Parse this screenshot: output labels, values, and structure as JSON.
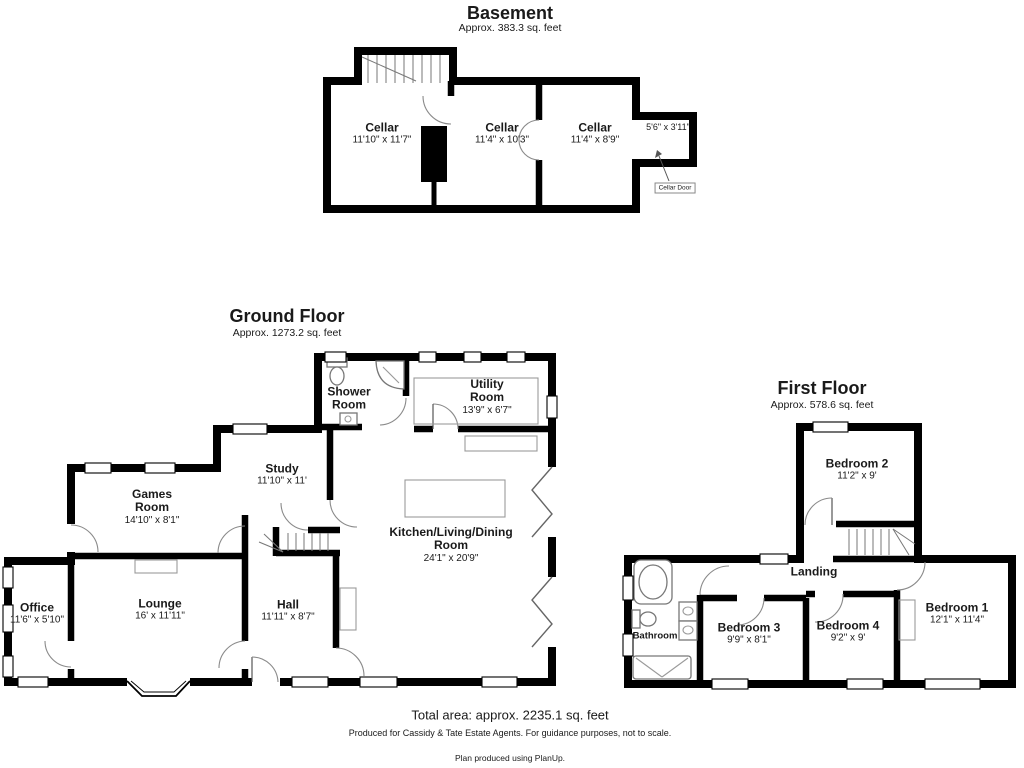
{
  "floors": {
    "basement": {
      "title": "Basement",
      "area": "Approx. 383.3 sq. feet",
      "rooms": [
        {
          "name": "Cellar",
          "dims": "11'10\" x 11'7\""
        },
        {
          "name": "Cellar",
          "dims": "11'4\" x 10'3\""
        },
        {
          "name": "Cellar",
          "dims": "11'4\" x 8'9\""
        }
      ],
      "annex_dims": "5'6\" x 3'11\"",
      "door_label": "Cellar Door"
    },
    "ground": {
      "title": "Ground Floor",
      "area": "Approx. 1273.2 sq. feet",
      "rooms": [
        {
          "name": "Shower Room",
          "dims": ""
        },
        {
          "name": "Utility Room",
          "dims": "13'9\" x 6'7\""
        },
        {
          "name": "Study",
          "dims": "11'10\" x 11'"
        },
        {
          "name": "Games Room",
          "dims": "14'10\" x 8'1\""
        },
        {
          "name": "Kitchen/Living/Dining Room",
          "dims": "24'1\" x 20'9\""
        },
        {
          "name": "Office",
          "dims": "11'6\" x 5'10\""
        },
        {
          "name": "Lounge",
          "dims": "16' x 11'11\""
        },
        {
          "name": "Hall",
          "dims": "11'11\" x 8'7\""
        }
      ]
    },
    "first": {
      "title": "First Floor",
      "area": "Approx. 578.6 sq. feet",
      "rooms": [
        {
          "name": "Bedroom 2",
          "dims": "11'2\" x 9'"
        },
        {
          "name": "Landing",
          "dims": ""
        },
        {
          "name": "Bathroom",
          "dims": ""
        },
        {
          "name": "Bedroom 3",
          "dims": "9'9\" x 8'1\""
        },
        {
          "name": "Bedroom 4",
          "dims": "9'2\" x 9'"
        },
        {
          "name": "Bedroom 1",
          "dims": "12'1\" x 11'4\""
        }
      ]
    }
  },
  "footer": {
    "total_area": "Total area: approx. 2235.1 sq. feet",
    "disclaimer": "Produced for Cassidy & Tate Estate Agents. For guidance purposes, not to scale.",
    "credit": "Plan produced using PlanUp."
  }
}
